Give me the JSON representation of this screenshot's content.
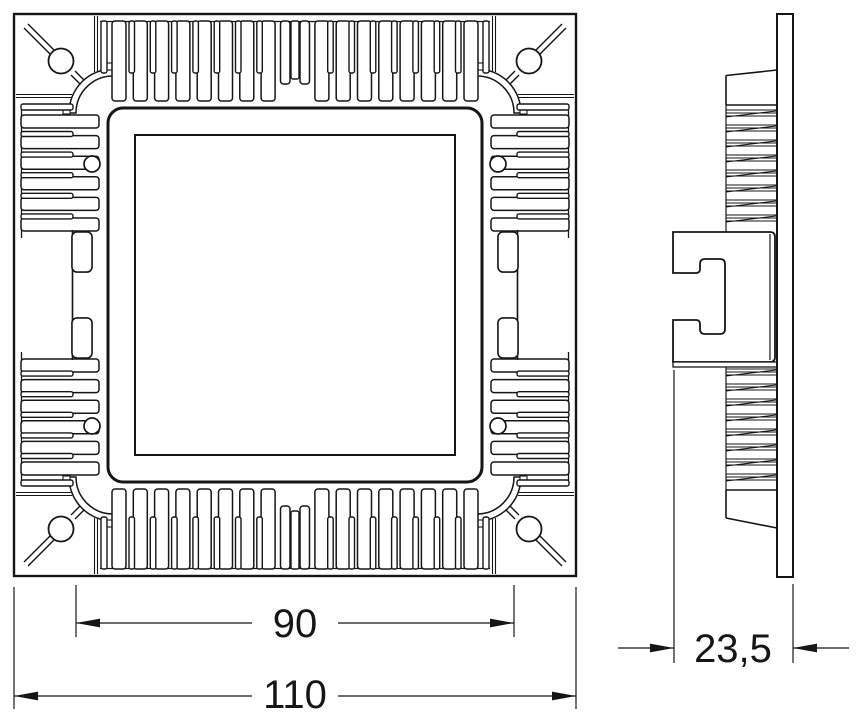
{
  "drawing": {
    "type": "technical-dimension-drawing",
    "subject": "square-led-downlight-heatsink",
    "views": [
      {
        "id": "front-view",
        "description": "front face with heatsink fins"
      },
      {
        "id": "side-view",
        "description": "side profile with mounting clip"
      }
    ],
    "dimensions": [
      {
        "id": "inner-width",
        "label": "90"
      },
      {
        "id": "outer-width",
        "label": "110"
      },
      {
        "id": "depth",
        "label": "23,5"
      }
    ]
  },
  "colors": {
    "line": "#161616",
    "background": "#ffffff"
  }
}
